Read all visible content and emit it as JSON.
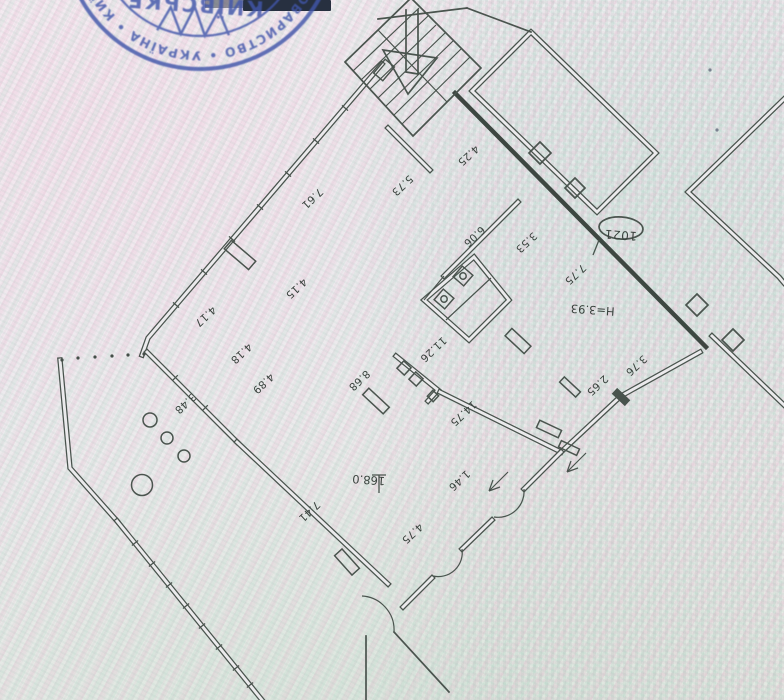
{
  "stamp": {
    "title_arc": "КИЇВСЬКЕ",
    "ring_text": "ТОВАРИСТВО  •  УКРАЇНА  •  КИЇВ  •",
    "ink_color": "#4156aa"
  },
  "plan": {
    "room_number": "1021",
    "height_note": "Н=3.93",
    "area_value": "168.0",
    "line_color": "#4a544e",
    "dimension_labels": [
      {
        "t": "4.25",
        "x": 466,
        "y": 153,
        "r": 137
      },
      {
        "t": "5.73",
        "x": 400,
        "y": 183,
        "r": 137
      },
      {
        "t": "7.61",
        "x": 310,
        "y": 196,
        "r": 137
      },
      {
        "t": "4.15",
        "x": 294,
        "y": 286,
        "r": 137
      },
      {
        "t": "4.17",
        "x": 203,
        "y": 314,
        "r": 137
      },
      {
        "t": "4.18",
        "x": 239,
        "y": 351,
        "r": 137
      },
      {
        "t": "4.89",
        "x": 261,
        "y": 381,
        "r": 137
      },
      {
        "t": "3.48",
        "x": 183,
        "y": 401,
        "r": 137
      },
      {
        "t": "6.06",
        "x": 472,
        "y": 234,
        "r": 137
      },
      {
        "t": "3.53",
        "x": 524,
        "y": 240,
        "r": 137
      },
      {
        "t": "7.75",
        "x": 573,
        "y": 272,
        "r": 137
      },
      {
        "t": "11.26",
        "x": 431,
        "y": 347,
        "r": 137
      },
      {
        "t": "8.68",
        "x": 357,
        "y": 378,
        "r": 137
      },
      {
        "t": "14.75",
        "x": 461,
        "y": 411,
        "r": 137
      },
      {
        "t": "1.46",
        "x": 457,
        "y": 478,
        "r": 137
      },
      {
        "t": "3.76",
        "x": 634,
        "y": 363,
        "r": 137
      },
      {
        "t": "2.65",
        "x": 595,
        "y": 383,
        "r": 137
      },
      {
        "t": "7.41",
        "x": 307,
        "y": 509,
        "r": 137
      },
      {
        "t": "4.75",
        "x": 410,
        "y": 531,
        "r": 137
      }
    ],
    "annotations": [
      {
        "t": "Н=3.93",
        "x": 593,
        "y": 306,
        "r": 184,
        "cls": "ann"
      },
      {
        "t": "168.0",
        "x": 369,
        "y": 476,
        "r": 184,
        "cls": "ann"
      },
      {
        "t": "1021",
        "x": 621,
        "y": 231,
        "r": 184,
        "cls": "room"
      }
    ]
  }
}
